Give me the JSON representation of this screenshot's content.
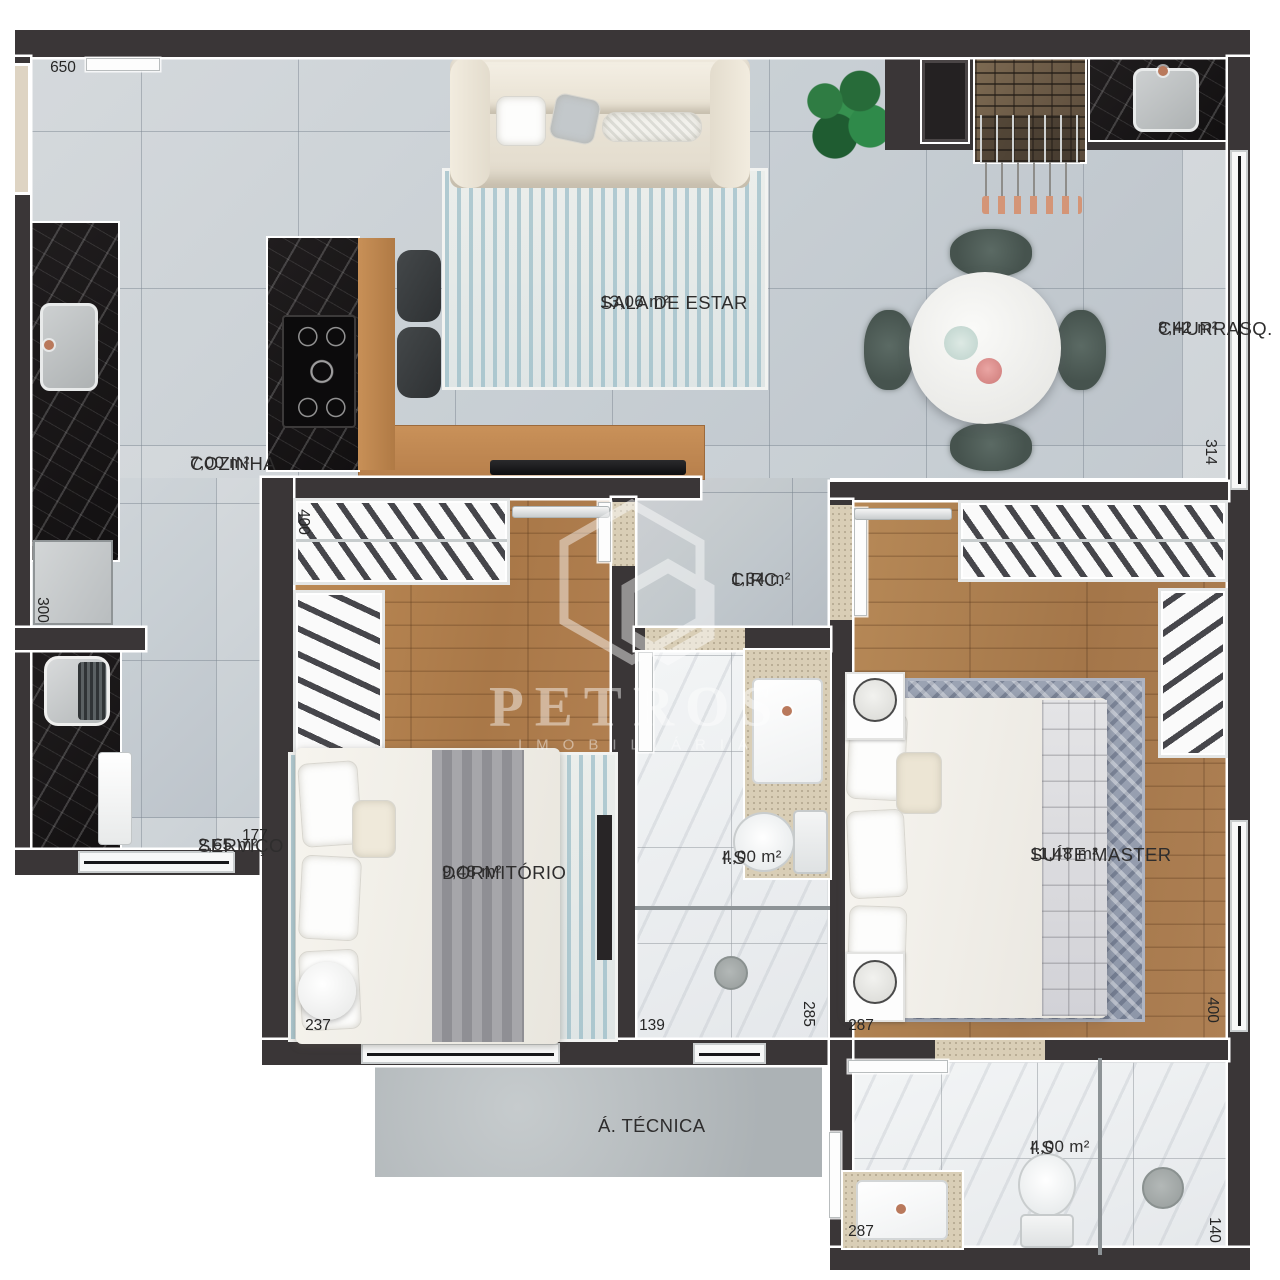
{
  "plan_title": "Apartment floor plan",
  "watermark": {
    "brand": "PETROS",
    "sub": "IMOBILIÁRIA"
  },
  "rooms": [
    {
      "id": "sala",
      "name": "SALA DE ESTAR",
      "area": "13,06 m²"
    },
    {
      "id": "churrasq",
      "name": "CHURRASQ.",
      "area": "8,42 m²"
    },
    {
      "id": "cozinha",
      "name": "COZINHA",
      "area": "7,00 m²"
    },
    {
      "id": "servico",
      "name": "SERVIÇO",
      "area": "2,65 m²"
    },
    {
      "id": "circ",
      "name": "CIRC.",
      "area": "1,34 m²"
    },
    {
      "id": "dormitorio",
      "name": "DORMITÓRIO",
      "area": "9,48 m²"
    },
    {
      "id": "is-social",
      "name": "I.S",
      "area": "4,00 m²"
    },
    {
      "id": "suite",
      "name": "SUÍTE MASTER",
      "area": "11,48 m²"
    },
    {
      "id": "is-suite",
      "name": "I.S",
      "area": "4,00 m²"
    },
    {
      "id": "atecnica",
      "name": "Á. TÉCNICA",
      "area": ""
    }
  ],
  "dims": [
    {
      "id": "top-left-width",
      "value": "650"
    },
    {
      "id": "kitchen-left-height",
      "value": "300"
    },
    {
      "id": "servico-width",
      "value": "177"
    },
    {
      "id": "dorm-height",
      "value": "400"
    },
    {
      "id": "dorm-width",
      "value": "237"
    },
    {
      "id": "is-social-width",
      "value": "139"
    },
    {
      "id": "is-social-height",
      "value": "285"
    },
    {
      "id": "suite-width",
      "value": "287"
    },
    {
      "id": "suite-height",
      "value": "400"
    },
    {
      "id": "churrasq-height",
      "value": "314"
    },
    {
      "id": "is-suite-width",
      "value": "287"
    },
    {
      "id": "is-suite-height",
      "value": "140"
    }
  ],
  "colors": {
    "wall": "#3a3637",
    "floor_tile": "#c9d0d5",
    "wood": "#b08050",
    "marble": "#eef0f1",
    "concrete": "#b3b8ba",
    "black_counter": "#171415",
    "rug_blue": "#a9c6ce",
    "rug_gray": "#97a0b0",
    "chair_green": "#4d5a55",
    "copper": "#c98a6a"
  }
}
